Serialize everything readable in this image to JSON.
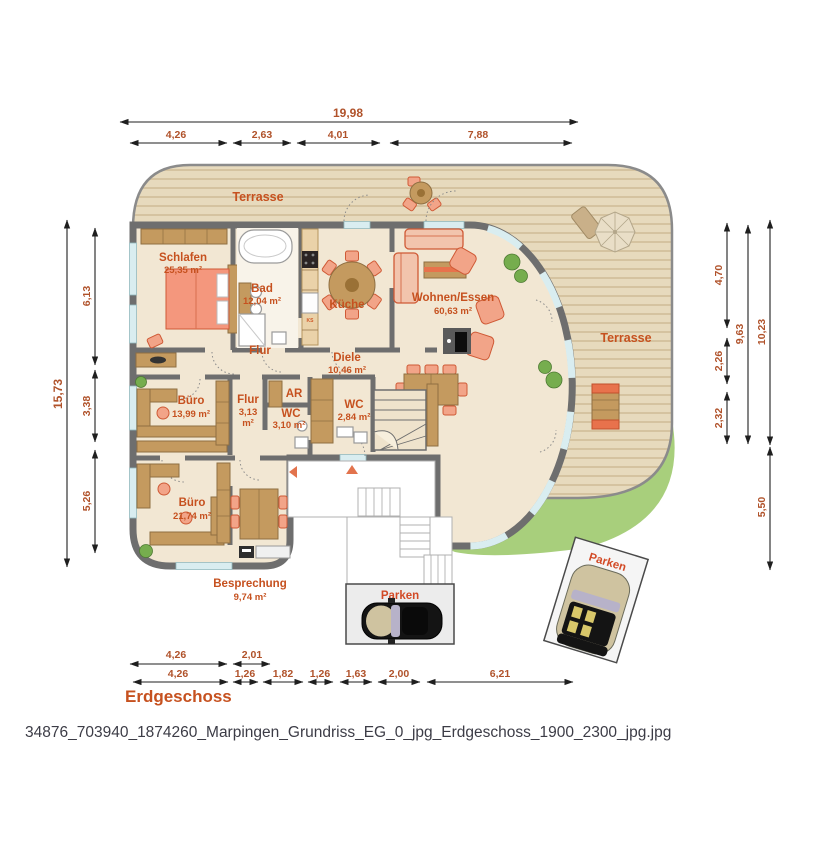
{
  "dims": {
    "top_total": "19,98",
    "top": [
      "4,26",
      "2,63",
      "4,01",
      "7,88"
    ],
    "left_total": "15,73",
    "left": [
      "6,13",
      "3,38",
      "5,26"
    ],
    "right": [
      "4,70",
      "2,26",
      "2,32"
    ],
    "right_sum": "9,63",
    "right_total": "10,23",
    "right_bottom": "5,50",
    "bottom_upper": [
      "4,26",
      "2,01"
    ],
    "bottom_lower": [
      "4,26",
      "1,26",
      "1,82",
      "1,26",
      "1,63",
      "2,00",
      "6,21"
    ]
  },
  "rooms": {
    "schlafen": {
      "name": "Schlafen",
      "area": "25,35 m²"
    },
    "bad": {
      "name": "Bad",
      "area": "12,04 m²"
    },
    "kueche": {
      "name": "Küche"
    },
    "wohnen": {
      "name": "Wohnen/Essen",
      "area": "60,63 m²"
    },
    "flur": {
      "name": "Flur"
    },
    "diele": {
      "name": "Diele",
      "area": "10,46 m²"
    },
    "buero1": {
      "name": "Büro",
      "area": "13,99 m²"
    },
    "flur2": {
      "name": "Flur",
      "area1": "3,13",
      "area2": "m²"
    },
    "ar": {
      "name": "AR"
    },
    "wc1": {
      "name": "WC",
      "area": "3,10 m²"
    },
    "wc2": {
      "name": "WC",
      "area": "2,84 m²"
    },
    "buero2": {
      "name": "Büro",
      "area": "21,74 m²"
    },
    "besprechung": {
      "name": "Besprechung",
      "area": "9,74 m²"
    }
  },
  "outdoor": {
    "terrasse_top": "Terrasse",
    "terrasse_right": "Terrasse",
    "parken1": "Parken",
    "parken2": "Parken",
    "kitchen_marker": "KS"
  },
  "footer": {
    "floor_label": "Erdgeschoss",
    "caption": "34876_703940_1874260_Marpingen_Grundriss_EG_0_jpg_Erdgeschoss_1900_2300_jpg.jpg"
  },
  "colors": {
    "accent_label": "#c6511f",
    "dimension_text": "#b0522a",
    "wall": "#6e6e6e",
    "terrace": "#e7dabd",
    "terrace_stripe": "#d5c3a0",
    "interior_floor": "#f2e7d3",
    "lawn": "#a8cf7c",
    "window": "#d9edf0",
    "wood": "#c49a5f",
    "upholstery": "#f2a488"
  }
}
